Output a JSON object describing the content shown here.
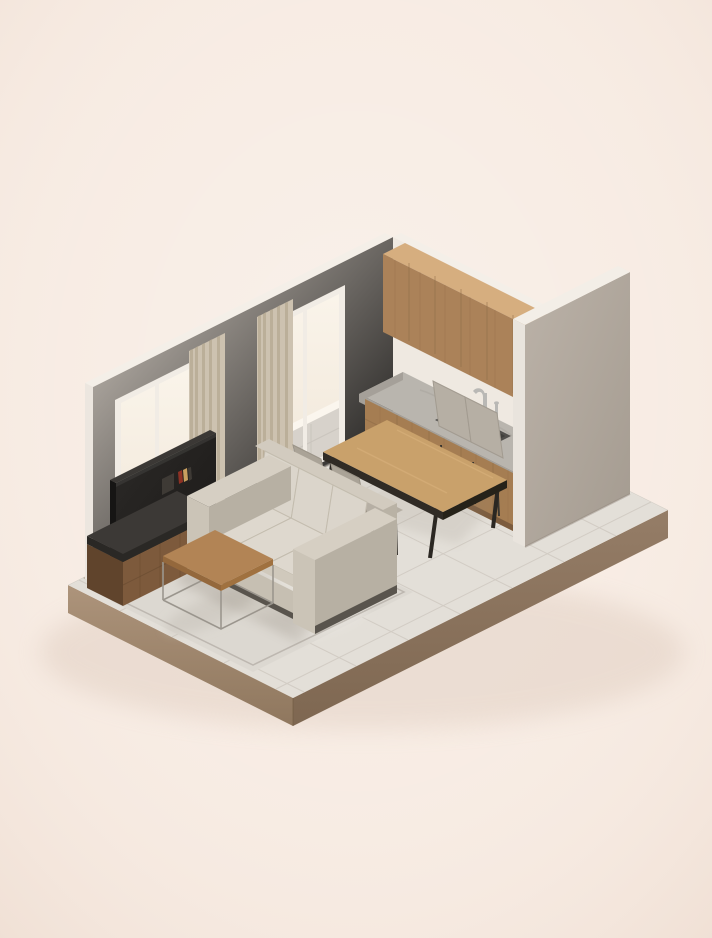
{
  "meta": {
    "kind": "isometric-3d-interior-render",
    "description": "Isometric cutaway render of a small apartment: living room with sofa, TV stand, coffee table and rug, dining table with four chairs, and a kitchen run with wood cabinets, stone countertop and sink, on a floating tiled plinth against a cream background."
  },
  "scene": {
    "objects": [
      "platform",
      "tiled-floor",
      "left-wall",
      "back-wall",
      "partition-wall",
      "window-left",
      "window-right",
      "curtain-left",
      "curtain-right",
      "upper-cabinets",
      "countertop",
      "sink",
      "faucet",
      "base-cabinets",
      "dining-table",
      "dining-chairs",
      "sofa",
      "area-rug",
      "tv-stand",
      "tv",
      "coffee-table",
      "books"
    ]
  },
  "palette": {
    "bg": "#f7ebe2",
    "groundShadow": "#cdb6a5",
    "platformSE": "#8e7661",
    "platformSW": "#a38a6e",
    "tile": "#e3dfd8",
    "grout": "#cfc9c1",
    "marginStrip": "#b3a695",
    "wallLeft": "#c9c1b7",
    "wallRight": "#efe9e1",
    "topStrip": "#f4efe8",
    "endStrip": "#ece6df",
    "partitionFace": "#b2a99e",
    "partitionEnd": "#e9e4dd",
    "partitionTop": "#f3eee7",
    "windowFrame": "#f1ece5",
    "glass": "#f8f1e7",
    "balcony": "#d7d2cb",
    "balconyLine": "#c4bfb8",
    "curtain": "#cdc2b0",
    "curtainShade": "#b5a992",
    "cabinetTopWood": "#d6ae7f",
    "cabinetWood": "#ab8259",
    "cabinetWoodDark": "#8a6743",
    "cabinetEnd": "#8f6a46",
    "counterTop": "#b9b5ae",
    "counterMottle": "#a8a39b",
    "counterEdge": "#a5a099",
    "sinkRim": "#514f4c",
    "sinkBasin": "#2e2d2b",
    "sinkBoard": "#403f3c",
    "metal": "#b9b8b5",
    "baseWood": "#a57d52",
    "kick": "#7c5c3e",
    "tableWood": "#c9a16b",
    "tableGrain": "#d8b37e",
    "tableEdgeA": "#302b25",
    "tableEdgeB": "#262219",
    "tableLeg": "#2b2722",
    "chairBody": "#b6afa4",
    "chairBack": "#aaa397",
    "chairFront": "#a39c91",
    "chairLeg": "#39352f",
    "sofaTop": "#d2cbbf",
    "sofaEnd": "#b9b2a5",
    "sofaCushion": "#dbd5cb",
    "sofaSeat": "#ded8ce",
    "sofaSeatFront": "#d0c9bc",
    "sofaBase": "#c6bfb2",
    "sofaArmTop": "#d6cfc3",
    "sofaArmFront": "#cbc4b7",
    "sofaArmSide": "#b7b0a3",
    "sofaPlinth": "#59544d",
    "seam": "#c3bcae",
    "rug": "#dcd8d1",
    "rugBorder": "#b5afa7",
    "rugLight": "#e9e5de",
    "rugShade": "#c9c4bc",
    "standWood": "#7d5a3c",
    "standWoodEnd": "#60442c",
    "standGrain": "#5d4128",
    "standSlab": "#3c3936",
    "standSlabEdge": "#2a2825",
    "tvPanel": "#242220",
    "tvTop": "#3b3835",
    "tvEnd": "#161514",
    "bookRed": "#8d3124",
    "bookTan": "#c99f5f",
    "bookDark": "#3e3a35",
    "coffeeWood": "#b28455",
    "coffeeEdgeA": "#94683c",
    "coffeeEdgeB": "#a0713f",
    "coffeeLeg": "#9b968e",
    "shadow": "#8a8175",
    "reflection": "#ffffff"
  }
}
